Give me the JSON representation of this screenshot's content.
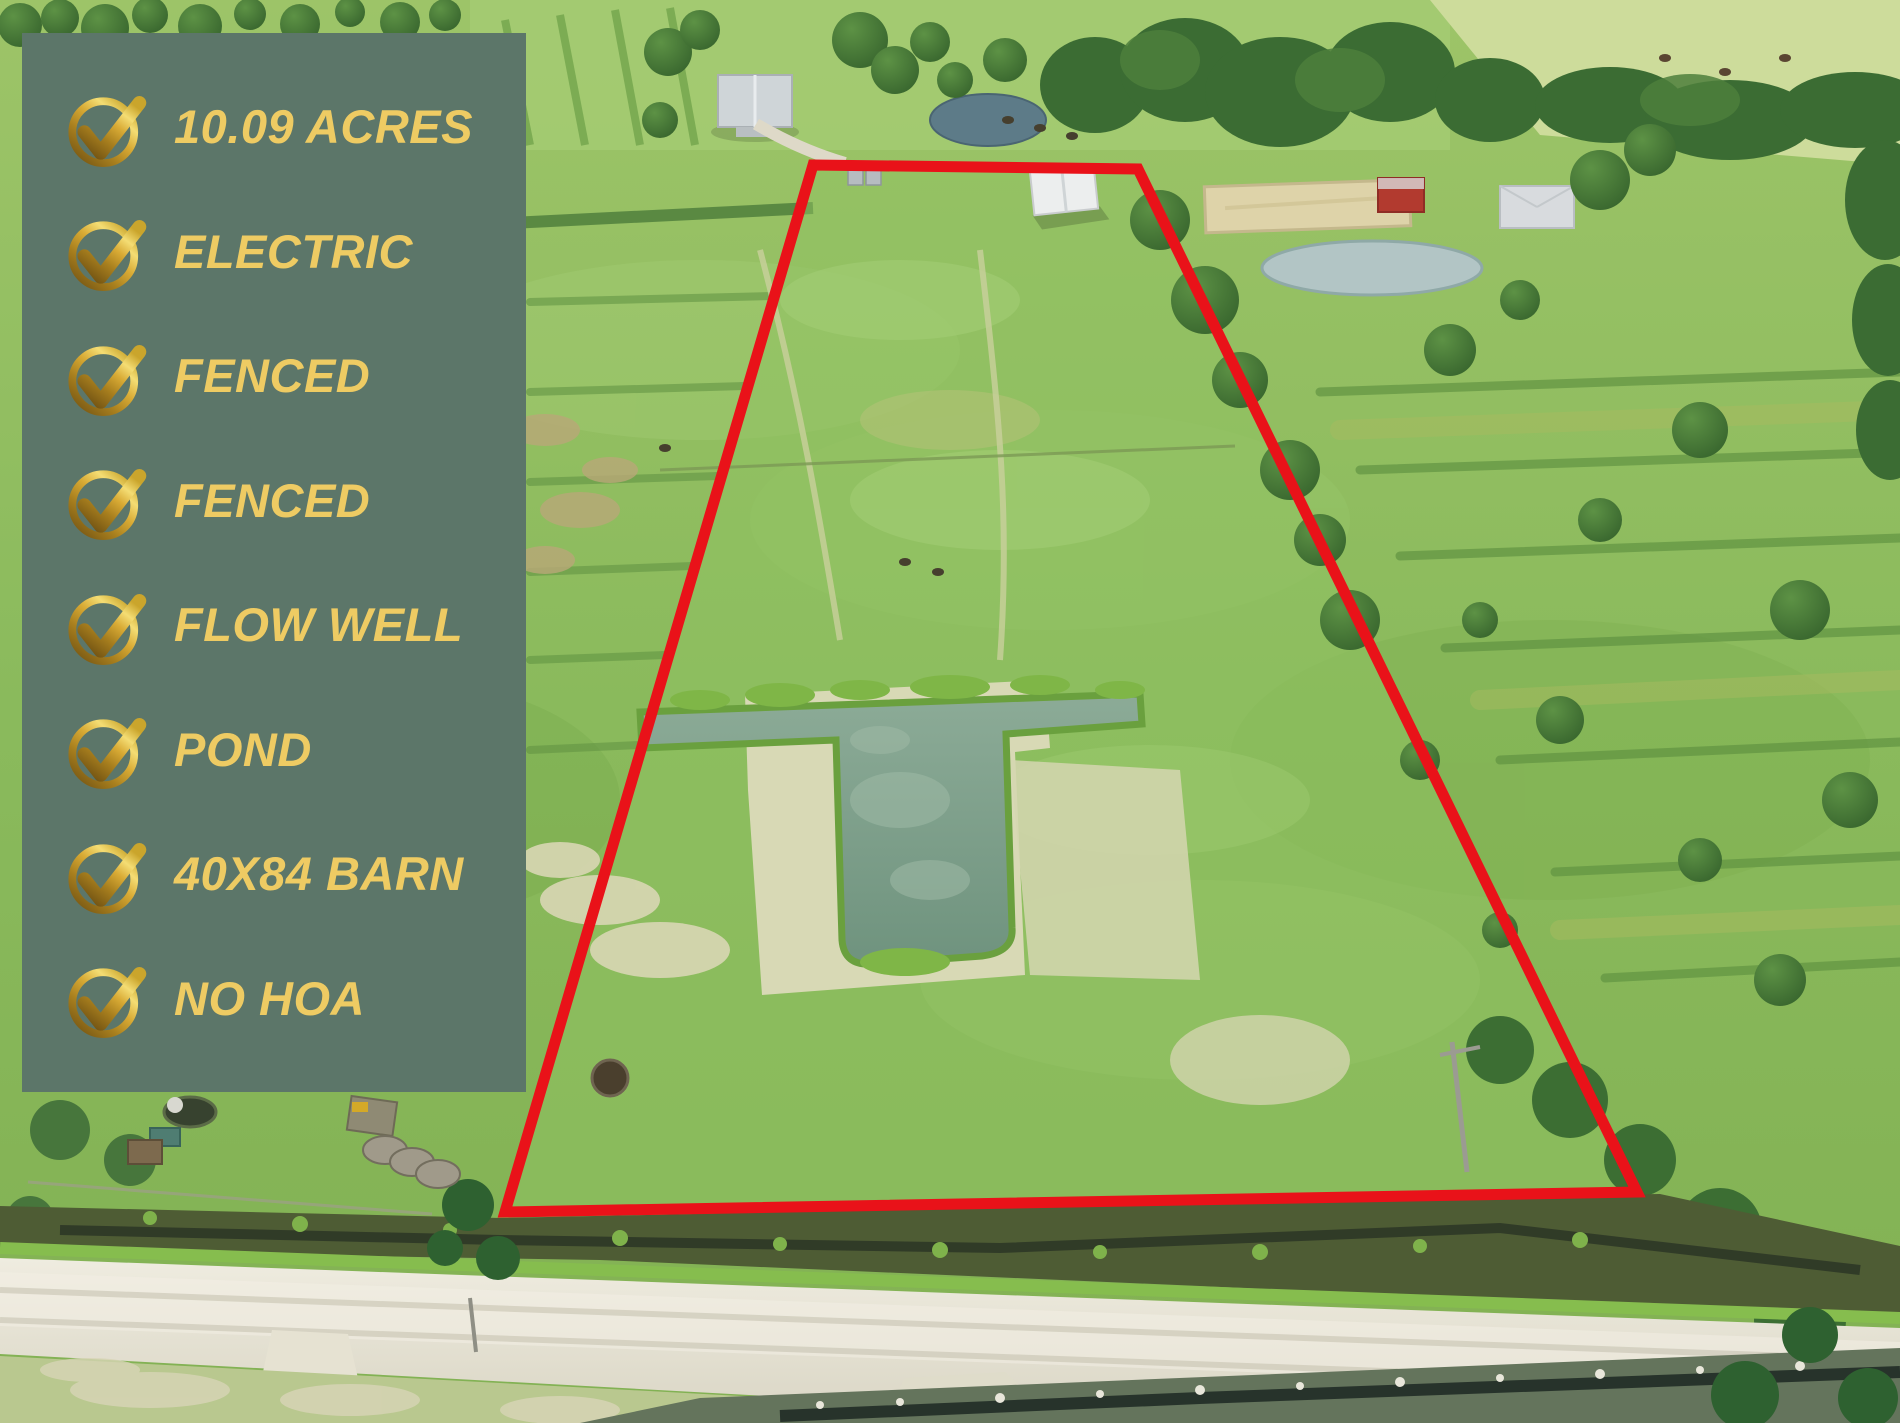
{
  "overlay": {
    "panel_color": "#5c7669",
    "text_color": "#eecb63",
    "check_gold_dark": "#6e5012",
    "check_gold_light": "#f4dd74",
    "items": [
      "10.09 ACRES",
      "ELECTRIC",
      "FENCED",
      "FENCED",
      "FLOW WELL",
      "POND",
      "40X84 BARN",
      "NO HOA"
    ]
  },
  "boundary": {
    "color": "#e91219",
    "stroke_width": "11",
    "points": "813,165 1138,169 1637,1192 505,1212"
  },
  "scene": {
    "colors": {
      "grass": "#84b458",
      "grass_light": "#a6cc74",
      "pasture_pale": "#cddc9b",
      "trees": "#3b6c33",
      "sand": "#d8d9b5",
      "property_pond_water": "#7fa591",
      "neighbor_pond_top": "#5d7b88",
      "neighbor_pond_right": "#b2c5c5",
      "arena_sand": "#ded3a9",
      "barn_roof": "#eceeee",
      "house_roof": "#d8dbde",
      "red_barn": "#b23a2f",
      "road": "#e6e2d3",
      "ditch": "#4e5c34",
      "canal_water": "#27332b"
    }
  }
}
